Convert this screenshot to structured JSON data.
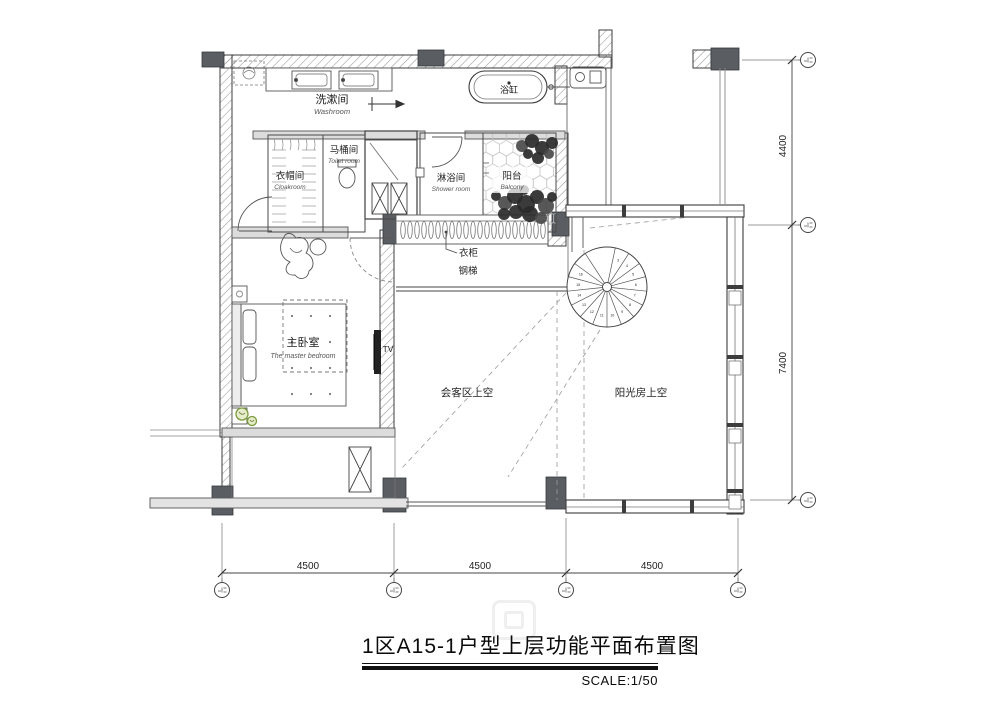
{
  "title_block": {
    "title": "1区A15-1户型上层功能平面布置图",
    "scale": "SCALE:1/50"
  },
  "labels": {
    "washroom_zh": "洗漱间",
    "washroom_en": "Washroom",
    "toilet_zh": "马桶间",
    "toilet_en": "Toilet room",
    "cloakroom_zh": "衣帽间",
    "cloakroom_en": "Cloakroom",
    "shower_zh": "淋浴间",
    "shower_en": "Shower room",
    "balcony_zh": "阳台",
    "balcony_en": "Balcony",
    "bathtub_zh": "浴缸",
    "wardrobe_zh": "衣柜",
    "steel_stair_zh": "钢梯",
    "bedroom_zh": "主卧室",
    "bedroom_en": "The master bedroom",
    "living_void_zh": "会客区上空",
    "sunroom_void_zh": "阳光房上空",
    "tv": "TV"
  },
  "dimensions": {
    "bottom": [
      "4500",
      "4500",
      "4500"
    ],
    "right_top": "4400",
    "right_bottom": "7400"
  },
  "spiral_stair": {
    "tread_numbers": [
      "3",
      "4",
      "5",
      "6",
      "7",
      "8",
      "9",
      "10",
      "11",
      "12",
      "13",
      "14",
      "15",
      "16"
    ]
  },
  "colors": {
    "line": "#333333",
    "wall_fill": "#dcdcdc",
    "column": "#5a5e63",
    "hatch": "#989898",
    "plant_green": "#7a9a3d"
  }
}
